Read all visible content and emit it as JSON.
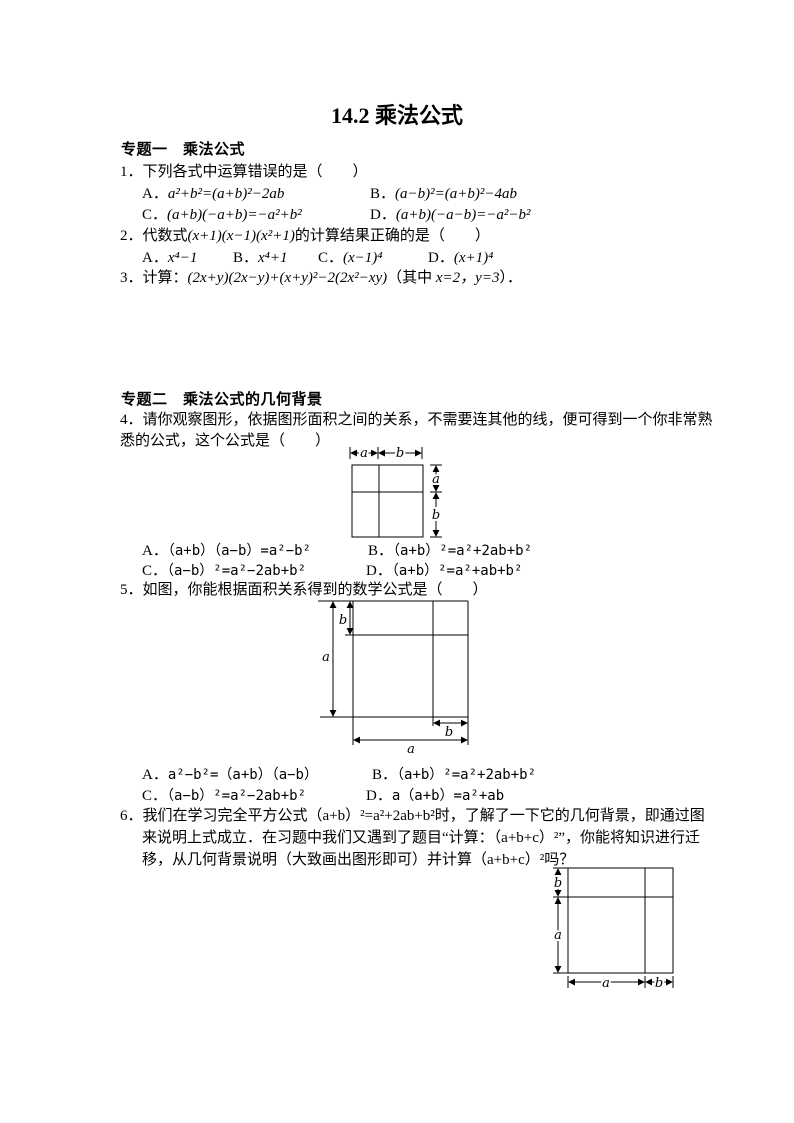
{
  "page": {
    "title": "14.2 乘法公式"
  },
  "section1": {
    "heading": "专题一　乘法公式"
  },
  "q1": {
    "stem": "1．下列各式中运算错误的是（　　）",
    "options": [
      {
        "label": "A．",
        "formula": "a²+b²=(a+b)²−2ab"
      },
      {
        "label": "B．",
        "formula": "(a−b)²=(a+b)²−4ab"
      },
      {
        "label": "C．",
        "formula": "(a+b)(−a+b)=−a²+b²"
      },
      {
        "label": "D．",
        "formula": "(a+b)(−a−b)=−a²−b²"
      }
    ]
  },
  "q2": {
    "stem_prefix": "2．代数式",
    "stem_math": "(x+1)(x−1)(x²+1)",
    "stem_suffix": "的计算结果正确的是（　　）",
    "options": [
      {
        "label": "A．",
        "formula": "x⁴−1"
      },
      {
        "label": "B．",
        "formula": "x⁴+1"
      },
      {
        "label": "C．",
        "formula": "(x−1)⁴"
      },
      {
        "label": "D．",
        "formula": "(x+1)⁴"
      }
    ]
  },
  "q3": {
    "prefix": "3．计算：",
    "math": "(2x+y)(2x−y)+(x+y)²−2(2x²−xy)",
    "suffix_open": "（其中 ",
    "condition": "x=2，y=3",
    "suffix_close": "）．"
  },
  "section2": {
    "heading": "专题二　乘法公式的几何背景"
  },
  "q4": {
    "line1": "4．请你观察图形，依据图形面积之间的关系，不需要连其他的线，便可得到一个你非常熟",
    "line2": "悉的公式，这个公式是（　　）",
    "options": [
      {
        "label": "A．",
        "formula": "（a+b）（a−b）=a²−b²"
      },
      {
        "label": "B．",
        "formula": "（a+b）²=a²+2ab+b²"
      },
      {
        "label": "C．",
        "formula": "（a−b）²=a²−2ab+b²"
      },
      {
        "label": "D．",
        "formula": "（a+b）²=a²+ab+b²"
      }
    ]
  },
  "q5": {
    "stem": "5．如图，你能根据面积关系得到的数学公式是（　　）",
    "options": [
      {
        "label": "A．",
        "formula": "a²−b²=（a+b）（a−b）"
      },
      {
        "label": "B．",
        "formula": "（a+b）²=a²+2ab+b²"
      },
      {
        "label": "C．",
        "formula": "（a−b）²=a²−2ab+b²"
      },
      {
        "label": "D．",
        "formula": "a（a+b）=a²+ab"
      }
    ]
  },
  "q6": {
    "line1": "6．我们在学习完全平方公式（a+b）²=a²+2ab+b²时，了解了一下它的几何背景，即通过图",
    "line2": "来说明上式成立．在习题中我们又遇到了题目“计算：（a+b+c）²”，你能将知识进行迁",
    "line3": "移，从几何背景说明（大致画出图形即可）并计算（a+b+c）²吗？"
  },
  "fig1": {
    "labels": {
      "top_a": "a",
      "top_b": "b",
      "right_a": "a",
      "right_b": "b"
    }
  },
  "fig2": {
    "shade_color": "#b3b3b3",
    "labels": {
      "left_a": "a",
      "left_b": "b",
      "bottom_a": "a",
      "bottom_b": "b"
    }
  },
  "fig3": {
    "labels": {
      "left_a": "a",
      "left_b": "b",
      "bottom_a": "a",
      "bottom_b": "b"
    }
  }
}
